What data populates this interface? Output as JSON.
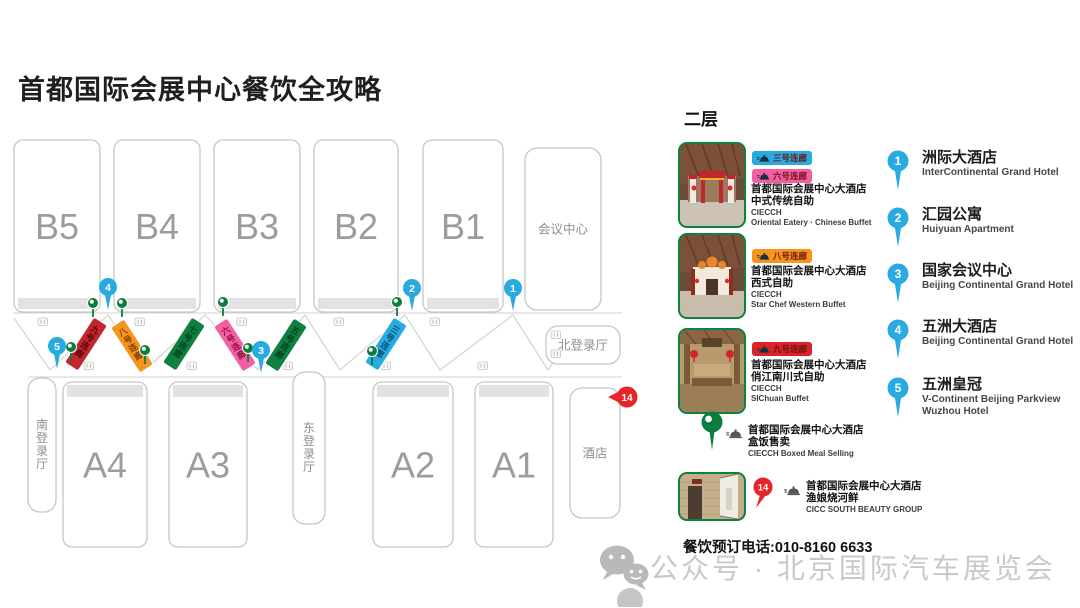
{
  "title": "首都国际会展中心餐饮全攻略",
  "floor_label": "二层",
  "phone": "餐饮预订电话:010-8160 6633",
  "watermark": "公众号 · 北京国际汽车展览会",
  "colors": {
    "blue": "#29ABE2",
    "pink": "#F45FA4",
    "orange": "#F7941D",
    "red": "#D9232A",
    "dark_red": "#C1272D",
    "green": "#0C7C3C",
    "marker_red": "#E8232A",
    "hall_stroke": "#C7C7C7",
    "hall_label": "#9C9C9C"
  },
  "map": {
    "halls": [
      {
        "label": "B5",
        "x": 14,
        "y": 140,
        "w": 86,
        "h": 172,
        "big": true,
        "cap": "bottom"
      },
      {
        "label": "B4",
        "x": 114,
        "y": 140,
        "w": 86,
        "h": 172,
        "big": true,
        "cap": "bottom"
      },
      {
        "label": "B3",
        "x": 214,
        "y": 140,
        "w": 86,
        "h": 172,
        "big": true,
        "cap": "bottom"
      },
      {
        "label": "B2",
        "x": 314,
        "y": 140,
        "w": 84,
        "h": 172,
        "big": true,
        "cap": "bottom"
      },
      {
        "label": "B1",
        "x": 423,
        "y": 140,
        "w": 80,
        "h": 172,
        "big": true,
        "cap": "bottom"
      },
      {
        "label": "会议中心",
        "x": 525,
        "y": 148,
        "w": 76,
        "h": 162
      },
      {
        "label": "A4",
        "x": 63,
        "y": 382,
        "w": 84,
        "h": 165,
        "big": true,
        "cap": "top"
      },
      {
        "label": "A3",
        "x": 169,
        "y": 382,
        "w": 78,
        "h": 165,
        "big": true,
        "cap": "top"
      },
      {
        "label": "A2",
        "x": 373,
        "y": 382,
        "w": 80,
        "h": 165,
        "big": true,
        "cap": "top"
      },
      {
        "label": "A1",
        "x": 475,
        "y": 382,
        "w": 78,
        "h": 165,
        "big": true,
        "cap": "top"
      },
      {
        "label": "酒店",
        "x": 570,
        "y": 388,
        "w": 50,
        "h": 130
      },
      {
        "label": "南登录厅",
        "x": 28,
        "y": 378,
        "w": 28,
        "h": 134,
        "vertical": true
      },
      {
        "label": "东登录厅",
        "x": 293,
        "y": 372,
        "w": 32,
        "h": 152,
        "vertical": true
      },
      {
        "label": "北登录厅",
        "x": 546,
        "y": 326,
        "w": 74,
        "h": 38
      }
    ],
    "corridors": [
      {
        "name": "九号连廊",
        "color": "#C1272D",
        "text_color": "#56090B",
        "x": 86,
        "y": 344,
        "slash": true
      },
      {
        "name": "八号连廊",
        "color": "#F7941D",
        "text_color": "#7C3F03",
        "x": 132,
        "y": 346,
        "slash": false
      },
      {
        "name": "七号连廊",
        "color": "#0E8040",
        "text_color": "#05401F",
        "x": 184,
        "y": 344,
        "slash": true
      },
      {
        "name": "六号连廊",
        "color": "#F45FA4",
        "text_color": "#8C1240",
        "x": 235,
        "y": 345,
        "slash": false
      },
      {
        "name": "五号连廊",
        "color": "#0E8040",
        "text_color": "#05401F",
        "x": 286,
        "y": 345,
        "slash": true
      },
      {
        "name": "三号连廊",
        "color": "#29ABE2",
        "text_color": "#0B4E74",
        "x": 386,
        "y": 344,
        "slash": true
      }
    ],
    "numbered_pins": [
      {
        "n": "4",
        "x": 108,
        "y": 287
      },
      {
        "n": "2",
        "x": 412,
        "y": 288
      },
      {
        "n": "1",
        "x": 513,
        "y": 288
      },
      {
        "n": "5",
        "x": 57,
        "y": 346
      },
      {
        "n": "3",
        "x": 261,
        "y": 350
      }
    ],
    "green_pins": [
      [
        93,
        303
      ],
      [
        122,
        303
      ],
      [
        223,
        302
      ],
      [
        397,
        302
      ],
      [
        71,
        347
      ],
      [
        145,
        350
      ],
      [
        248,
        348
      ],
      [
        372,
        351
      ]
    ],
    "red_marker": {
      "n": "14",
      "x": 627,
      "y": 397
    },
    "utensil_icons": [
      [
        38,
        318
      ],
      [
        135,
        318
      ],
      [
        237,
        318
      ],
      [
        334,
        318
      ],
      [
        430,
        318
      ],
      [
        551,
        331
      ],
      [
        551,
        350
      ],
      [
        84,
        362
      ],
      [
        187,
        362
      ],
      [
        283,
        362
      ],
      [
        381,
        362
      ],
      [
        478,
        362
      ]
    ]
  },
  "legend": {
    "rows": [
      {
        "tags": [
          {
            "label": "三号连廊",
            "color": "#29ABE2"
          },
          {
            "label": "六号连廊",
            "color": "#F45FA4"
          }
        ],
        "title": "首都国际会展中心大酒店",
        "subtitle": "中式传统自助",
        "en1": "CIECCH",
        "en2": "Oriental Eatery · Chinese Buffet"
      },
      {
        "tags": [
          {
            "label": "八号连廊",
            "color": "#F7941D"
          }
        ],
        "title": "首都国际会展中心大酒店",
        "subtitle": "西式自助",
        "en1": "CIECCH",
        "en2": "Star Chef Western Buffet"
      },
      {
        "tags": [
          {
            "label": "九号连廊",
            "color": "#D9232A"
          }
        ],
        "title": "首都国际会展中心大酒店",
        "subtitle": "俏江南川式自助",
        "en1": "CIECCH",
        "en2": "SIChuan Buffet"
      },
      {
        "title": "首都国际会展中心大酒店",
        "subtitle": "盒饭售卖",
        "en1": "CIECCH Boxed Meal Selling"
      },
      {
        "pin": "14",
        "title": "首都国际会展中心大酒店",
        "subtitle": "渔娘烧河鲜",
        "en1": "CICC SOUTH BEAUTY GROUP"
      }
    ]
  },
  "hotels": [
    {
      "num": "1",
      "zh": "洲际大酒店",
      "en": "InterContinental Grand Hotel"
    },
    {
      "num": "2",
      "zh": "汇园公寓",
      "en": "Huiyuan Apartment"
    },
    {
      "num": "3",
      "zh": "国家会议中心",
      "en": "Beijing Continental Grand Hotel"
    },
    {
      "num": "4",
      "zh": "五洲大酒店",
      "en": "Beijing Continental Grand Hotel"
    },
    {
      "num": "5",
      "zh": "五洲皇冠",
      "en": "V-Continent Beijing Parkview",
      "en2": "Wuzhou Hotel"
    }
  ]
}
